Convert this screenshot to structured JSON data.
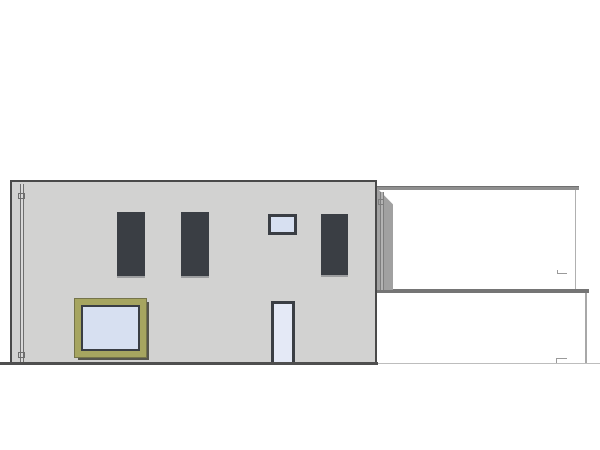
{
  "drawing": {
    "kind": "architectural-elevation",
    "colors": {
      "background": "#ffffff",
      "facade": "#d2d2d1",
      "facade_border": "#4a4a4a",
      "window_frame": "#3a3e44",
      "glass": "#d7e0f1",
      "glass_door": "#e4e9f6",
      "spandrel": "#b5bbc7",
      "glass_divider": "#5a5e66",
      "big_window_frame": "#a6a560",
      "big_window_shadow": "#55554d",
      "shadow": "#a1a1a1",
      "pipe_line": "#6e6e6e",
      "upper_box_band": "#8f8f8f",
      "upper_box_edge": "#b0b0b0",
      "lower_box_band": "#757575",
      "lower_box_edge": "#a8a8a8",
      "ground_dark": "#4f4f4f",
      "ground_light": "#bdbdbd",
      "mark": "#9a9a9a"
    },
    "windows": [
      {
        "name": "window-upper-1",
        "type": "tall",
        "x": 117,
        "y": 212,
        "w": 28,
        "h": 64
      },
      {
        "name": "window-upper-2",
        "type": "tall",
        "x": 181,
        "y": 212,
        "w": 28,
        "h": 64
      },
      {
        "name": "window-small",
        "type": "small",
        "x": 268,
        "y": 214,
        "w": 29,
        "h": 21
      },
      {
        "name": "window-upper-3",
        "type": "tall",
        "x": 321,
        "y": 214,
        "w": 27,
        "h": 61
      },
      {
        "name": "window-large-fixed",
        "type": "fixed",
        "x": 75,
        "y": 299,
        "w": 71,
        "h": 58
      },
      {
        "name": "door-window",
        "type": "door",
        "x": 271,
        "y": 301,
        "w": 24,
        "h": 63
      }
    ]
  }
}
